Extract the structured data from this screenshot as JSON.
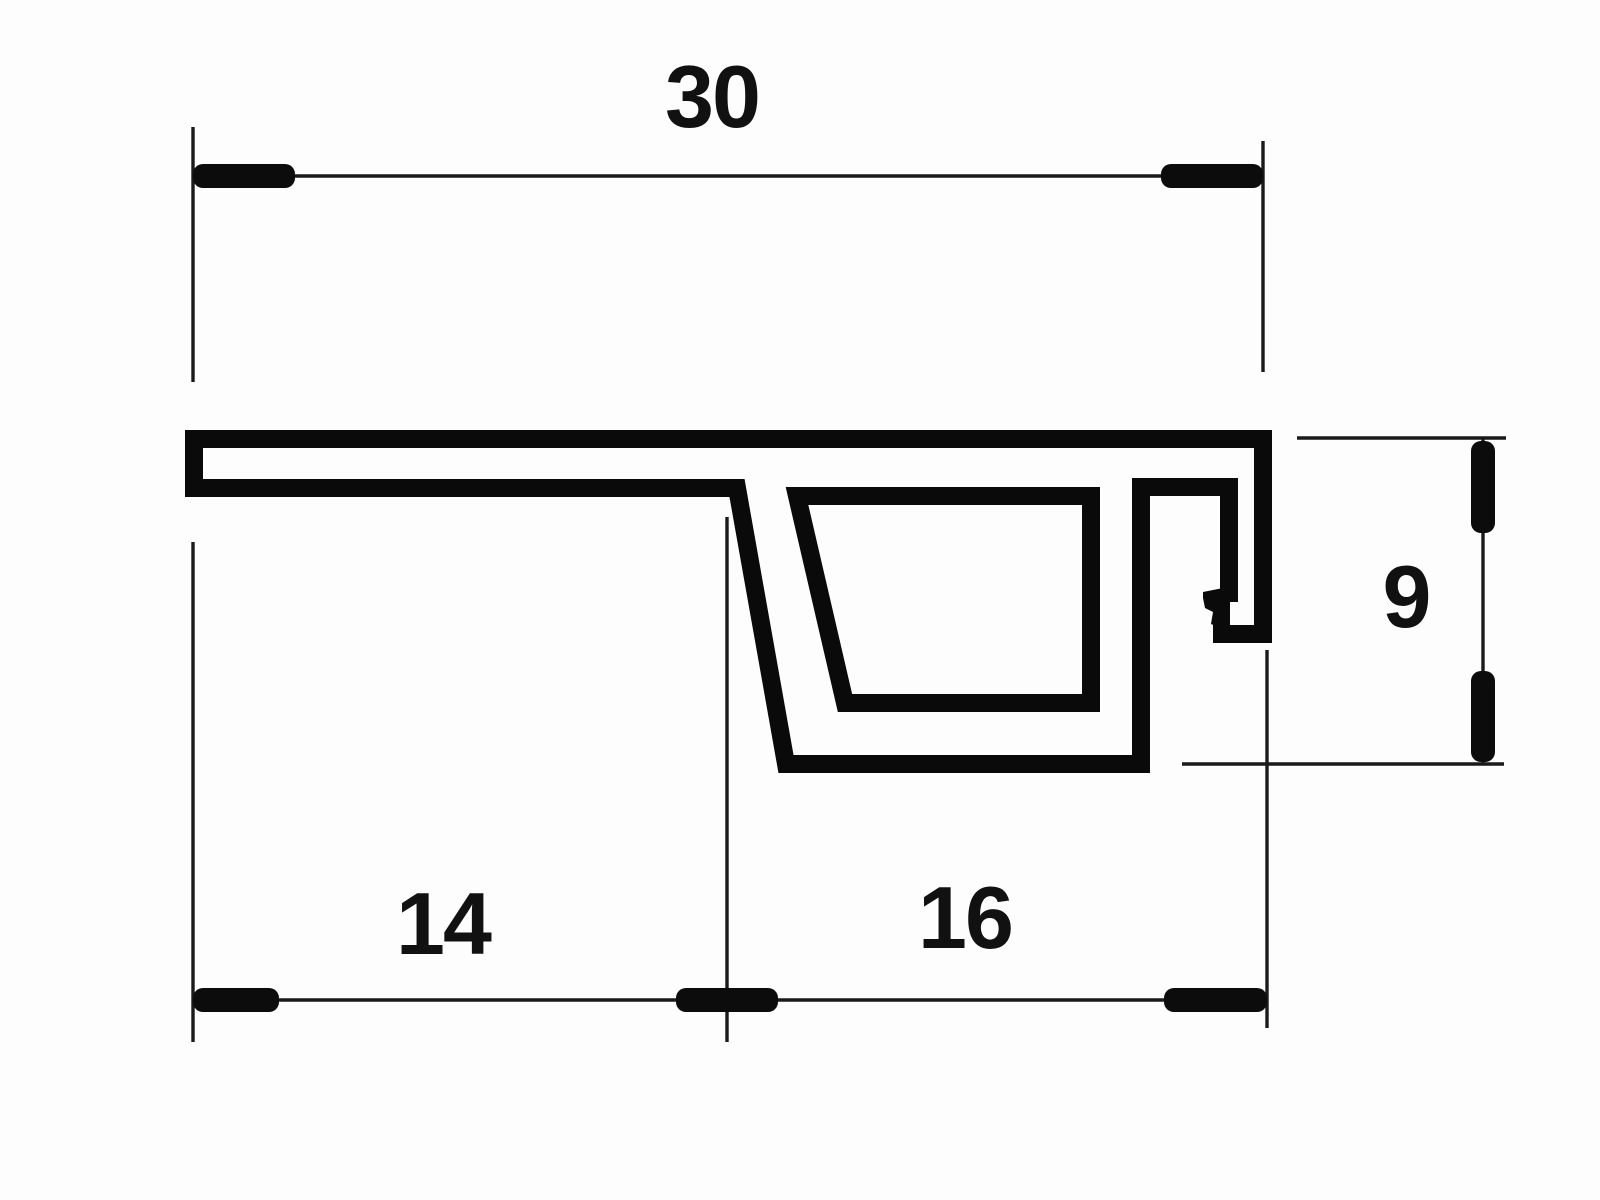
{
  "colors": {
    "background": "#fdfdfd",
    "profile_line": "#0a0a0a",
    "dimension_line": "#1a1a1a",
    "text": "#111111"
  },
  "dimensions": {
    "total_width": {
      "value": "30",
      "orientation": "horizontal",
      "position": "top"
    },
    "left_width": {
      "value": "14",
      "orientation": "horizontal",
      "position": "bottom-left"
    },
    "right_width": {
      "value": "16",
      "orientation": "horizontal",
      "position": "bottom-right"
    },
    "right_height": {
      "value": "9",
      "orientation": "vertical",
      "position": "right"
    }
  }
}
